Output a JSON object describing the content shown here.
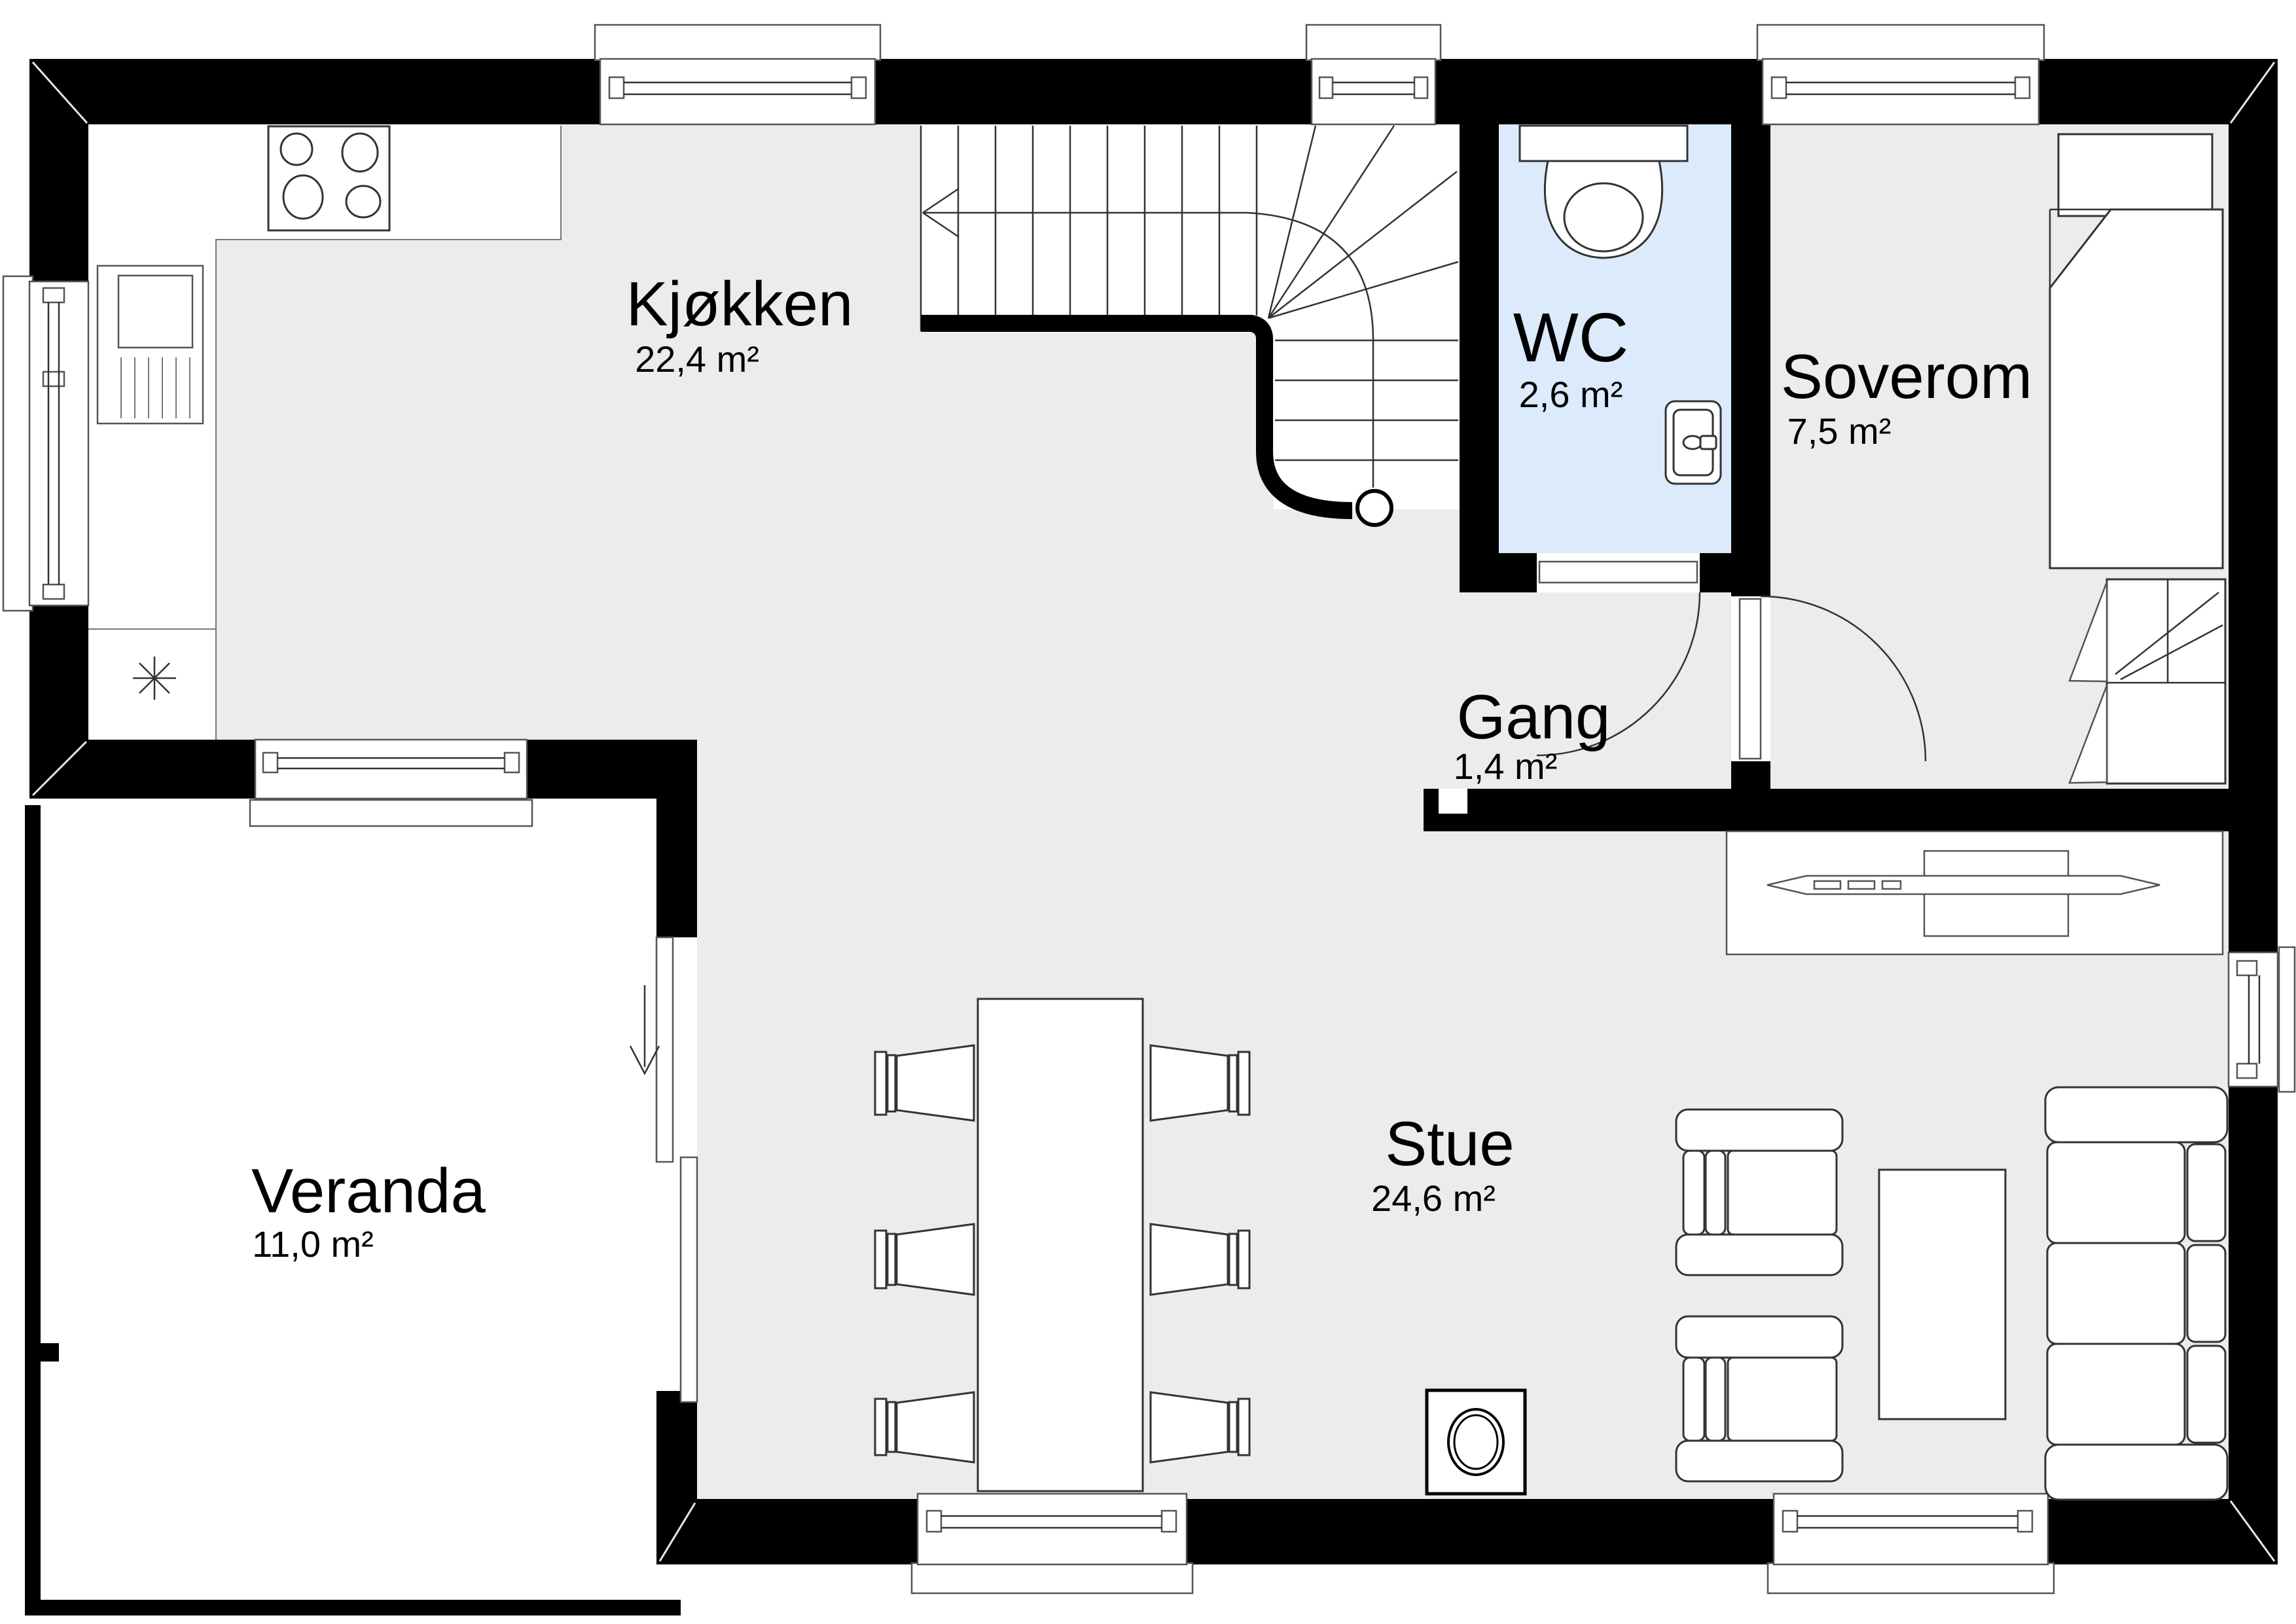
{
  "rooms": {
    "kjokken": {
      "label": "Kjøkken",
      "area": "22,4 m²"
    },
    "wc": {
      "label": "WC",
      "area": "2,6 m²"
    },
    "soverom": {
      "label": "Soverom",
      "area": "7,5 m²"
    },
    "gang": {
      "label": "Gang",
      "area": "1,4 m²"
    },
    "stue": {
      "label": "Stue",
      "area": "24,6 m²"
    },
    "veranda": {
      "label": "Veranda",
      "area": "11,0 m²"
    }
  },
  "colors": {
    "wall": "#000000",
    "floor": "#ececec",
    "wc_floor": "#dcebfb",
    "line": "#333333"
  }
}
